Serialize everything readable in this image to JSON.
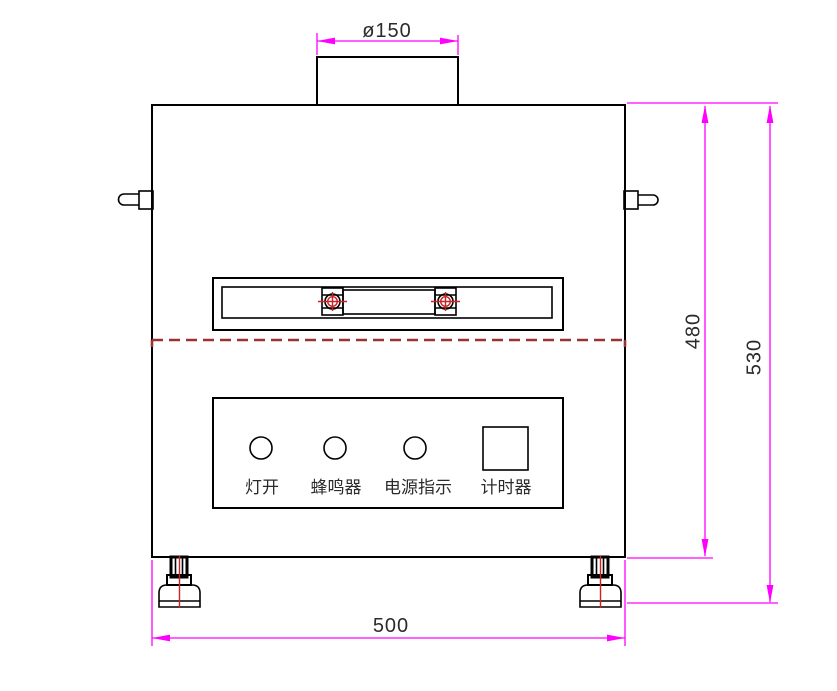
{
  "drawing": {
    "dimensions": {
      "chimney_diameter": "ø150",
      "body_height": "480",
      "total_height": "530",
      "body_width": "500"
    },
    "panel_labels": [
      "灯开",
      "蜂鸣器",
      "电源指示",
      "计时器"
    ],
    "colors": {
      "outline": "#000000",
      "dimension": "#ff00ff",
      "hinge_dashed": "#993333",
      "center_mark": "#cc2222",
      "text": "#2b2b2b"
    }
  }
}
